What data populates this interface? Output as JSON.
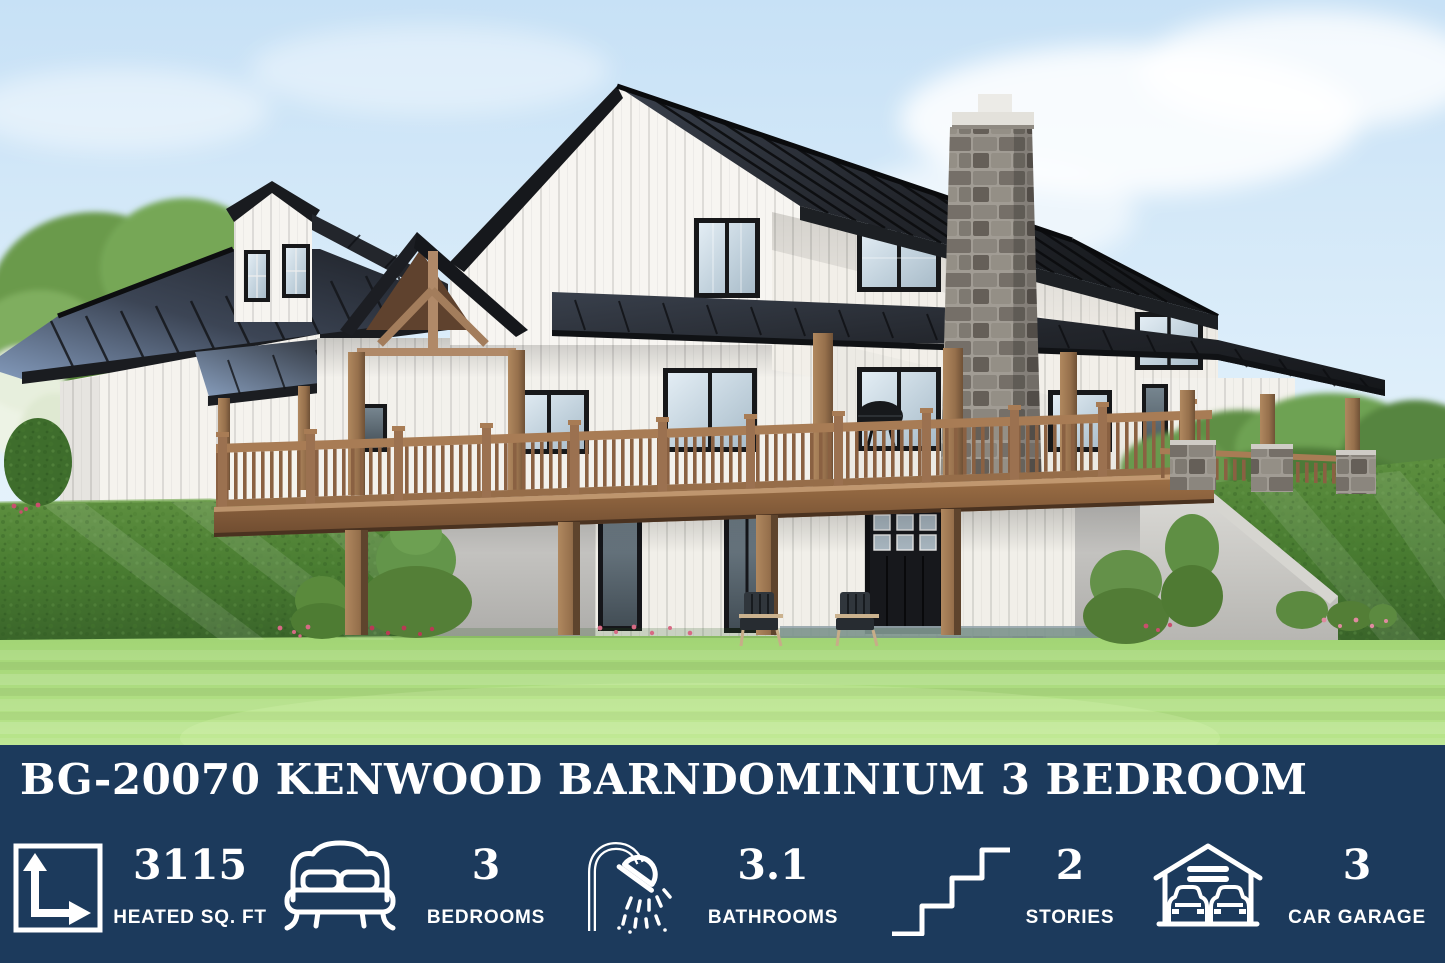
{
  "banner": {
    "background_color": "#1c3a5c",
    "text_color": "#ffffff",
    "title": "BG-20070 KENWOOD BARNDOMINIUM 3 BEDROOM",
    "stats": [
      {
        "icon": "area-dimensions-icon",
        "value": "3115",
        "label": "HEATED SQ. FT"
      },
      {
        "icon": "bed-icon",
        "value": "3",
        "label": "BEDROOMS"
      },
      {
        "icon": "shower-icon",
        "value": "3.1",
        "label": "BATHROOMS"
      },
      {
        "icon": "stairs-icon",
        "value": "2",
        "label": "STORIES"
      },
      {
        "icon": "garage-icon",
        "value": "3",
        "label": "CAR GARAGE"
      }
    ]
  },
  "scene": {
    "palette": {
      "sky": "#cfe6f8",
      "roof_metal": "#1d2024",
      "roof_sheen": "#7d93b4",
      "siding_white": "#f5f3ee",
      "timber_wood": "#9c7354",
      "deck_wood": "#8a6342",
      "stone_gray": "#8b867e",
      "concrete": "#c2c2be",
      "hedge_green": "#4a7d35",
      "lawn_green": "#9ed06b",
      "window_black": "#17181a"
    }
  }
}
